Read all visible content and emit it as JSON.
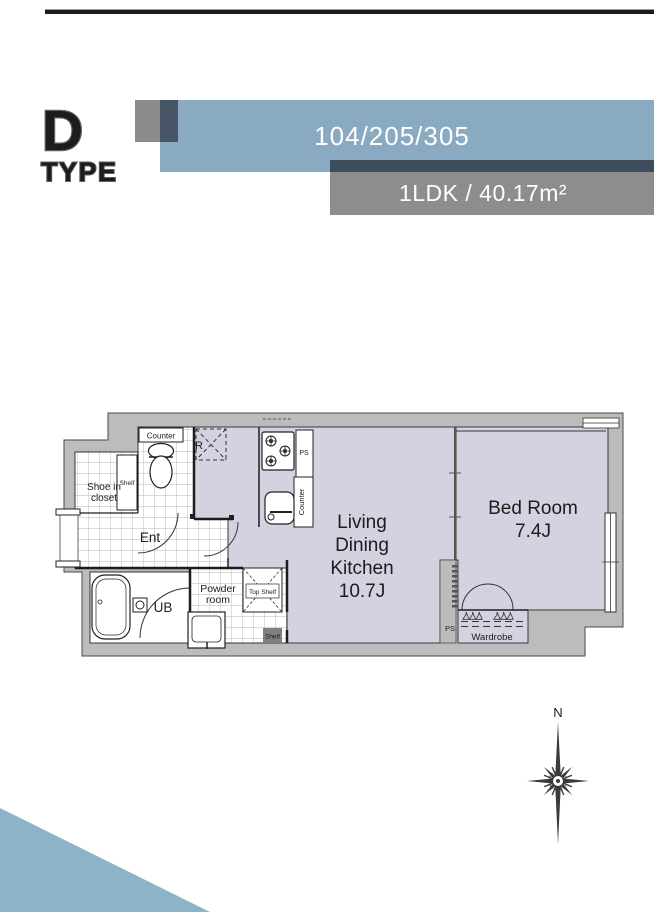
{
  "header": {
    "type_logo": {
      "letter": "D",
      "word": "TYPE"
    },
    "unit_numbers": "104/205/305",
    "unit_spec": "1LDK / 40.17m²",
    "colors": {
      "bar_blue": "#8aaac1",
      "bar_gray": "#8f8c8d",
      "bar_dark": "#3d4d5c",
      "square_gray": "#8b8b8b",
      "square_dark": "#475567",
      "top_rule": "#1b1b1b"
    }
  },
  "floor_plan": {
    "colors": {
      "floor": "#d6d1e0",
      "wall": "#bcbcbc",
      "outline": "#4a4a4a"
    },
    "labels": {
      "ldk_lines": [
        "Living",
        "Dining",
        "Kitchen",
        "10.7J"
      ],
      "bedroom_name": "Bed Room",
      "bedroom_size": "7.4J",
      "entrance": "Ent",
      "unit_bath": "UB",
      "powder_lines": [
        "Powder",
        "room"
      ],
      "shoe_closet_lines": [
        "Shoe in",
        "closet"
      ],
      "toilet_counter": "Counter",
      "kitchen_counter": "Counter",
      "kitchen_ps": "PS",
      "bedroom_ps": "PS",
      "refrigerator": "R",
      "shoe_shelf": "Shelf",
      "powder_shelf": "Shelf",
      "top_shelf": "Top Shelf",
      "wardrobe": "Wardrobe"
    }
  },
  "compass": {
    "north": "N"
  }
}
